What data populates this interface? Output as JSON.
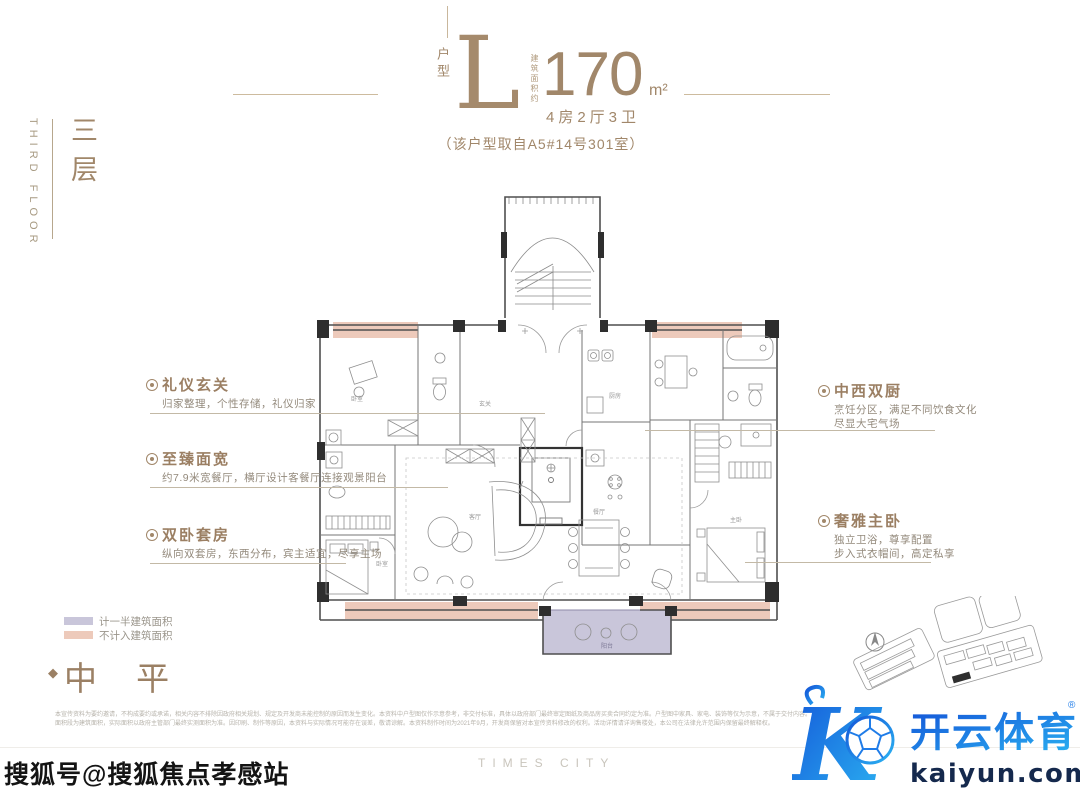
{
  "header": {
    "unit_type_label": "户型",
    "unit_type_letter": "L",
    "area_prefix": "建筑面积约",
    "area_value": "170",
    "area_unit": "m²",
    "layout_summary": "4房2厅3卫",
    "source_note": "（该户型取自A5#14号301室）"
  },
  "sidebar": {
    "floor_cn": "三层",
    "floor_en": "THIRD FLOOR"
  },
  "annotations": {
    "left": [
      {
        "title": "礼仪玄关",
        "desc": "归家整理，个性存储，礼仪归家"
      },
      {
        "title": "至臻面宽",
        "desc": "约7.9米宽餐厅，横厅设计客餐厅连接观景阳台"
      },
      {
        "title": "双卧套房",
        "desc": "纵向双套房，东西分布，宾主适宜，尽享主场"
      }
    ],
    "right": [
      {
        "title": "中西双厨",
        "desc1": "烹饪分区，满足不同饮食文化",
        "desc2": "尽显大宅气场"
      },
      {
        "title": "奢雅主卧",
        "desc1": "独立卫浴，尊享配置",
        "desc2": "步入式衣帽间，高定私享"
      }
    ]
  },
  "legend": [
    {
      "label": "计一半建筑面积",
      "color": "#c9c6da"
    },
    {
      "label": "不计入建筑面积",
      "color": "#edcabb"
    }
  ],
  "section_marker": {
    "bullet": "◆",
    "text": "中 平"
  },
  "floorplan": {
    "labels": [
      "卧室",
      "玄关",
      "厨房",
      "客厅",
      "餐厅",
      "主卧",
      "卧室",
      "阳台"
    ]
  },
  "disclaimer": {
    "line1": "本宣传资料为要约邀请，不构成要约或承诺，相关内容不排除因政府相关规划、规定及开发商未能控制的原因而发生变化。本资料中户型图仅作示意参考，非交付标准，具体以政府部门最终审定图纸及商品房买卖合同约定为准。户型图中家具、家电、装饰等仅为示意，不属于交付内容。",
    "line2": "面积段为建筑面积，实际面积以政府主管部门最终实测面积为准。因印刷、制作等原因，本资料与实际情况可能存在误差，敬请谅解。本资料制作时间为2021年9月，开发商保留对本宣传资料修改的权利。活动详情请详询售楼处，本公司在法律允许范围内保留最终解释权。"
  },
  "brand_footer": "TIMES CITY",
  "logo": {
    "letter": "K",
    "name_cn": "开云体育",
    "registered": "®",
    "domain": "kaiyun.com"
  },
  "watermark": "搜狐号@搜狐焦点孝感站",
  "colors": {
    "gold": "#9b8064",
    "accent_blue": "#1456d8",
    "accent_cyan": "#2bb3f2",
    "navy": "#15294d",
    "half_area": "#c9c6da",
    "excluded_area": "#edcabb"
  }
}
